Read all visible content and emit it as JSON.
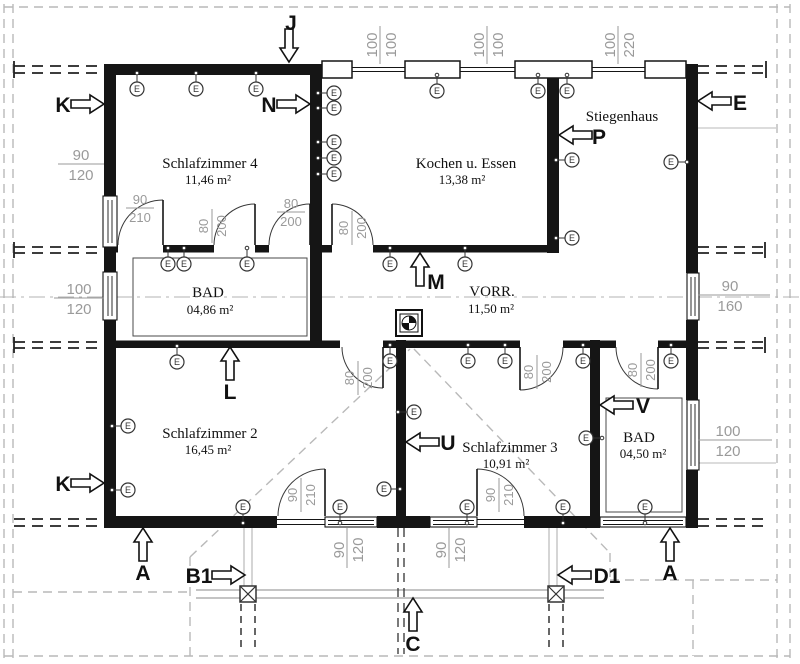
{
  "rooms": {
    "s4": {
      "name": "Schlafzimmer 4",
      "area": "11,46 m²"
    },
    "kochen": {
      "name": "Kochen u. Essen",
      "area": "13,38 m²"
    },
    "stiegenhaus": {
      "name": "Stiegenhaus",
      "area": ""
    },
    "bad_top": {
      "name": "BAD",
      "area": "04,86 m²"
    },
    "vorraum": {
      "name": "VORR.",
      "area": "11,50 m²"
    },
    "s2": {
      "name": "Schlafzimmer 2",
      "area": "16,45 m²"
    },
    "s3": {
      "name": "Schlafzimmer 3",
      "area": "10,91 m²"
    },
    "bad_bottom": {
      "name": "BAD",
      "area": "04,50 m²"
    }
  },
  "dims": {
    "d90_120": {
      "num": "90",
      "den": "120"
    },
    "d100_120": {
      "num": "100",
      "den": "120"
    },
    "d100_100": {
      "num": "100",
      "den": "100"
    },
    "d100_220": {
      "num": "100",
      "den": "220"
    },
    "d90_160": {
      "num": "90",
      "den": "160"
    },
    "d90_210": {
      "num": "90",
      "den": "210"
    },
    "d80_200": {
      "num": "80",
      "den": "200"
    }
  },
  "electrical": {
    "outlet_label": "E",
    "outlets": [
      {
        "x": 137,
        "y": 89,
        "d": "up"
      },
      {
        "x": 196,
        "y": 89,
        "d": "up"
      },
      {
        "x": 256,
        "y": 89,
        "d": "up"
      },
      {
        "x": 437,
        "y": 91,
        "d": "up"
      },
      {
        "x": 538,
        "y": 91,
        "d": "up"
      },
      {
        "x": 567,
        "y": 91,
        "d": "up"
      },
      {
        "x": 334,
        "y": 93,
        "d": "left"
      },
      {
        "x": 334,
        "y": 108,
        "d": "left"
      },
      {
        "x": 334,
        "y": 142,
        "d": "left"
      },
      {
        "x": 334,
        "y": 158,
        "d": "left"
      },
      {
        "x": 334,
        "y": 174,
        "d": "left"
      },
      {
        "x": 572,
        "y": 160,
        "d": "left"
      },
      {
        "x": 572,
        "y": 238,
        "d": "left"
      },
      {
        "x": 671,
        "y": 162,
        "d": "right"
      },
      {
        "x": 168,
        "y": 264,
        "d": "up"
      },
      {
        "x": 184,
        "y": 264,
        "d": "up"
      },
      {
        "x": 247,
        "y": 264,
        "d": "up"
      },
      {
        "x": 390,
        "y": 264,
        "d": "up"
      },
      {
        "x": 465,
        "y": 264,
        "d": "up"
      },
      {
        "x": 177,
        "y": 362,
        "d": "up"
      },
      {
        "x": 390,
        "y": 361,
        "d": "up"
      },
      {
        "x": 468,
        "y": 361,
        "d": "up"
      },
      {
        "x": 505,
        "y": 361,
        "d": "up"
      },
      {
        "x": 583,
        "y": 361,
        "d": "up"
      },
      {
        "x": 671,
        "y": 361,
        "d": "up"
      },
      {
        "x": 128,
        "y": 426,
        "d": "left"
      },
      {
        "x": 128,
        "y": 490,
        "d": "left"
      },
      {
        "x": 384,
        "y": 489,
        "d": "right"
      },
      {
        "x": 414,
        "y": 412,
        "d": "left"
      },
      {
        "x": 586,
        "y": 438,
        "d": "right"
      },
      {
        "x": 243,
        "y": 507,
        "d": "down"
      },
      {
        "x": 340,
        "y": 507,
        "d": "down"
      },
      {
        "x": 467,
        "y": 507,
        "d": "down"
      },
      {
        "x": 563,
        "y": 507,
        "d": "down"
      },
      {
        "x": 645,
        "y": 507,
        "d": "down"
      }
    ]
  },
  "section_marks": [
    {
      "label": "J",
      "tip": [
        289,
        62
      ],
      "dir": "down",
      "lpos": [
        291,
        30
      ]
    },
    {
      "label": "K",
      "tip": [
        104,
        104
      ],
      "dir": "right",
      "lpos": [
        63,
        112
      ]
    },
    {
      "label": "N",
      "tip": [
        310,
        104
      ],
      "dir": "right",
      "lpos": [
        269,
        112
      ]
    },
    {
      "label": "E",
      "tip": [
        698,
        101
      ],
      "dir": "left",
      "lpos": [
        740,
        110
      ]
    },
    {
      "label": "P",
      "tip": [
        559,
        135
      ],
      "dir": "left",
      "lpos": [
        599,
        144
      ]
    },
    {
      "label": "M",
      "tip": [
        420,
        253
      ],
      "dir": "up",
      "lpos": [
        436,
        289
      ]
    },
    {
      "label": "L",
      "tip": [
        230,
        347
      ],
      "dir": "up",
      "lpos": [
        230,
        399
      ]
    },
    {
      "label": "U",
      "tip": [
        406,
        442
      ],
      "dir": "left",
      "lpos": [
        448,
        450
      ]
    },
    {
      "label": "V",
      "tip": [
        600,
        405
      ],
      "dir": "left",
      "lpos": [
        643,
        413
      ]
    },
    {
      "label": "K",
      "tip": [
        104,
        483
      ],
      "dir": "right",
      "lpos": [
        63,
        491
      ]
    },
    {
      "label": "A",
      "tip": [
        143,
        528
      ],
      "dir": "up",
      "lpos": [
        143,
        580
      ]
    },
    {
      "label": "A",
      "tip": [
        670,
        528
      ],
      "dir": "up",
      "lpos": [
        670,
        580
      ]
    },
    {
      "label": "B1",
      "tip": [
        245,
        575
      ],
      "dir": "right",
      "lpos": [
        199,
        583
      ]
    },
    {
      "label": "D1",
      "tip": [
        558,
        575
      ],
      "dir": "left",
      "lpos": [
        607,
        583
      ]
    },
    {
      "label": "C",
      "tip": [
        413,
        598
      ],
      "dir": "up",
      "lpos": [
        413,
        651
      ]
    }
  ]
}
